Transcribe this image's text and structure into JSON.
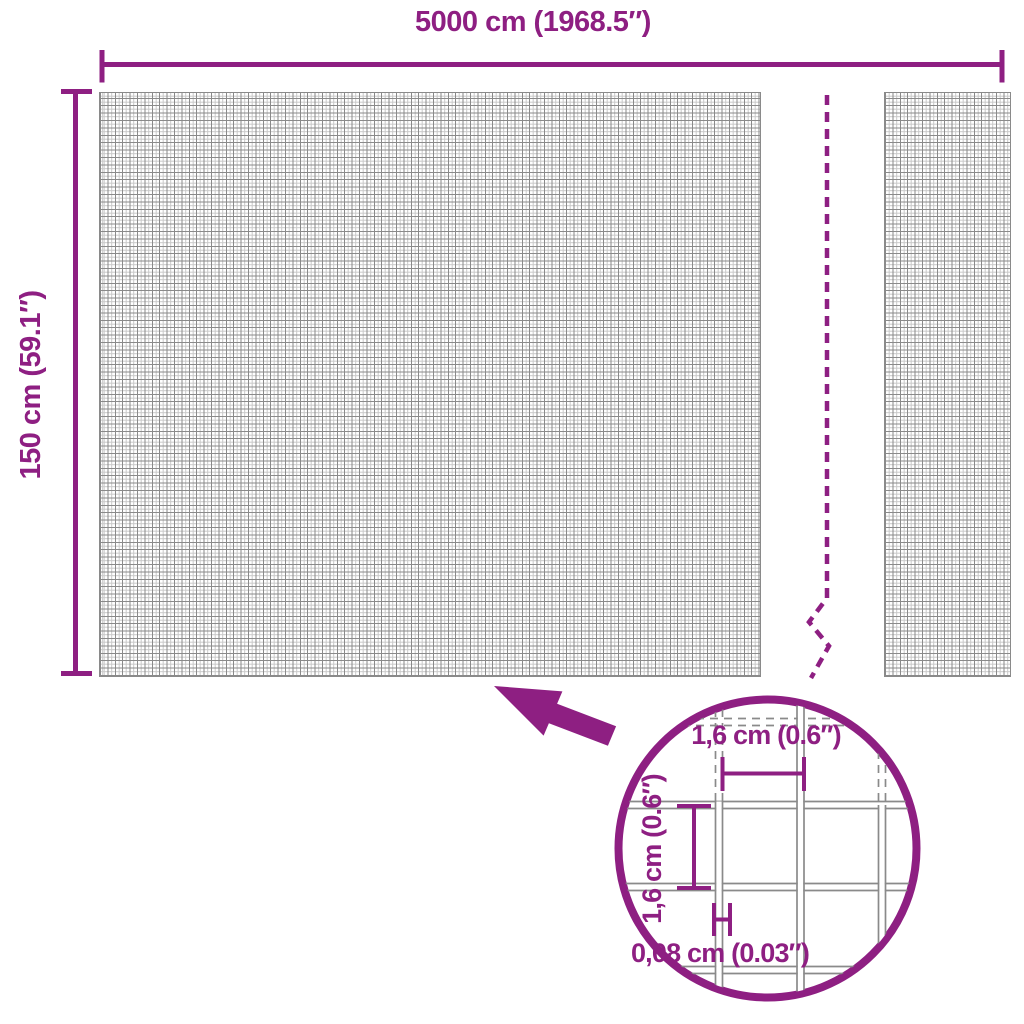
{
  "colors": {
    "accent": "#8e1f82",
    "grid_dark": "#8a8a8a",
    "grid_light": "#c9c9c9",
    "background": "#ffffff"
  },
  "overall": {
    "width_label": "5000 cm (1968.5″)",
    "height_label": "150 cm (59.1″)"
  },
  "inset": {
    "mesh_width_label": "1,6 cm (0.6″)",
    "mesh_height_label": "1,6 cm (0.6″)",
    "wire_thickness_label": "0,08 cm (0.03″)"
  },
  "icons": {
    "arrow": "zoom-pointer-arrow-icon",
    "circle": "magnifier-circle-icon"
  }
}
